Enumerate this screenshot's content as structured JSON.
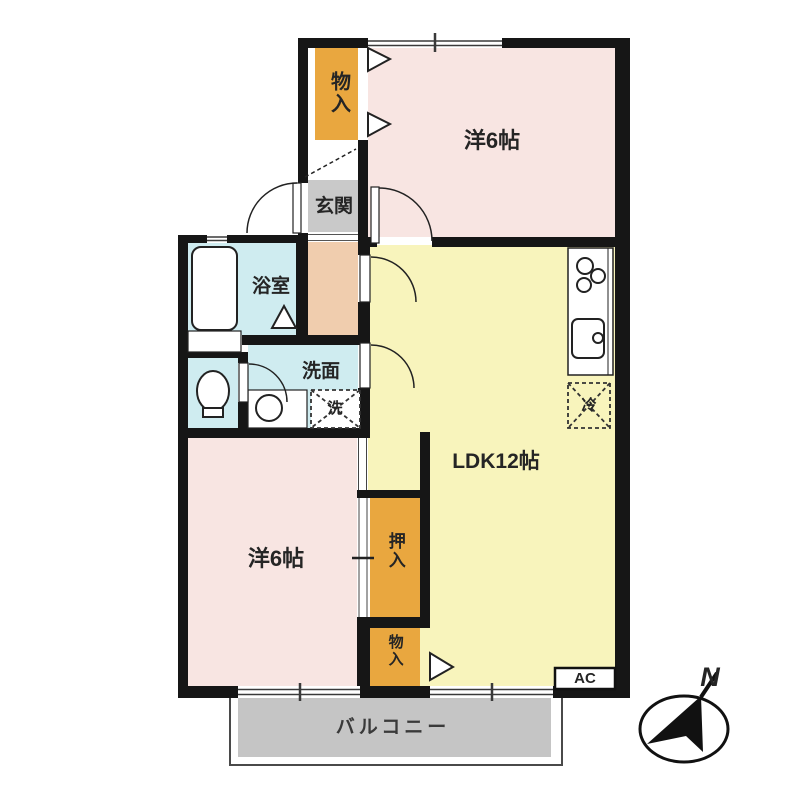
{
  "plan": {
    "rooms": {
      "western_room_top": {
        "label": "洋6帖"
      },
      "western_room_bottom": {
        "label": "洋6帖"
      },
      "ldk": {
        "label": "LDK12帖"
      },
      "entrance": {
        "label": "玄関"
      },
      "bathroom": {
        "label": "浴室"
      },
      "washroom": {
        "label": "洗面"
      },
      "storage_top": {
        "label": "物入"
      },
      "closet": {
        "label": "押入"
      },
      "storage_bottom": {
        "label": "物入"
      },
      "balcony": {
        "label": "バルコニー"
      }
    },
    "fixtures": {
      "washing_machine": {
        "label": "洗"
      },
      "refrigerator": {
        "label": "冷"
      },
      "air_conditioner": {
        "label": "AC"
      }
    },
    "compass": {
      "north_label": "N"
    },
    "colors": {
      "wall": "#161616",
      "room_pink": "#f8e5e2",
      "room_yellow": "#f8f4bc",
      "closet_orange": "#e9a73f",
      "wet_area_blue": "#cfecf0",
      "hall_peach": "#f0cdae",
      "entrance_gray": "#c9c9c9",
      "balcony_gray": "#c5c5c5"
    }
  }
}
